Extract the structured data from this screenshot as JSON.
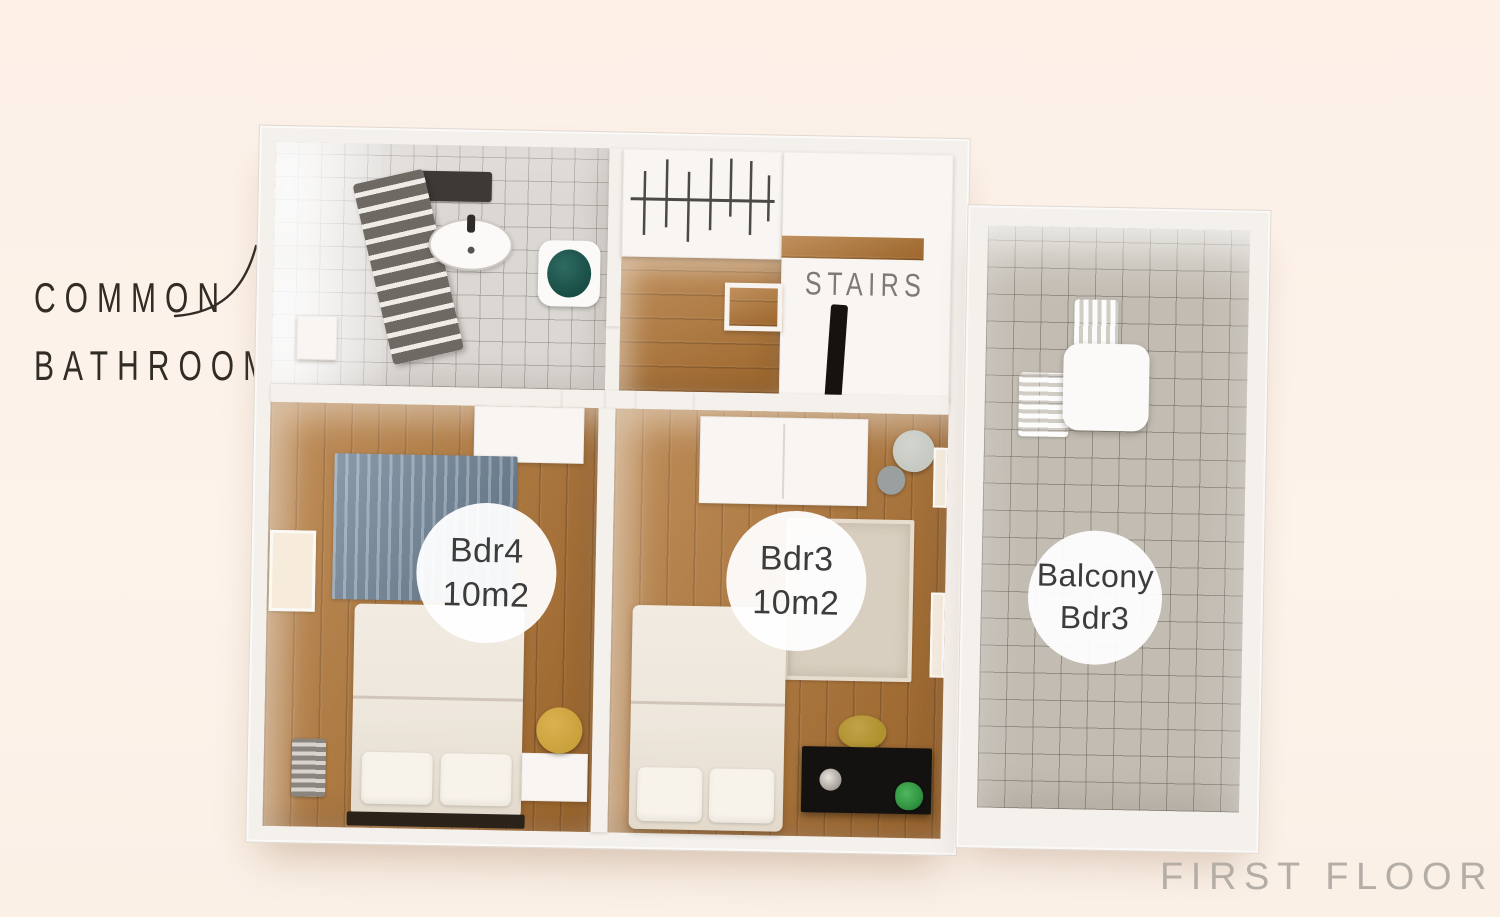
{
  "title": "FIRST FLOOR",
  "annotations": {
    "common_bathroom": {
      "line1": "COMMON",
      "line2": "BATHROOM"
    },
    "stairs": "STAIRS"
  },
  "badges": {
    "bdr4": {
      "line1": "Bdr4",
      "line2": "10m2"
    },
    "bdr3": {
      "line1": "Bdr3",
      "line2": "10m2"
    },
    "balcony": {
      "line1": "Balcony",
      "line2": "Bdr3"
    }
  },
  "colors": {
    "background": "#fcf0e7",
    "wall": "#f4f0ec",
    "wall_edge": "#e2dad2",
    "wood": "#ae7130",
    "bath_tile": "#dbd7d3",
    "balcony_tile": "#c2bcb2",
    "rug_blue": "#71879d",
    "rug_beige": "#d9cfc0",
    "bed": "#ede6db",
    "desk": "#141210",
    "plant": "#2f9140",
    "stool": "#c9a13b",
    "ink": "#312c26",
    "stairs_ink": "#7d7a76",
    "title_ink": "#b5aea7",
    "badge_ink": "#3c3c3c"
  }
}
